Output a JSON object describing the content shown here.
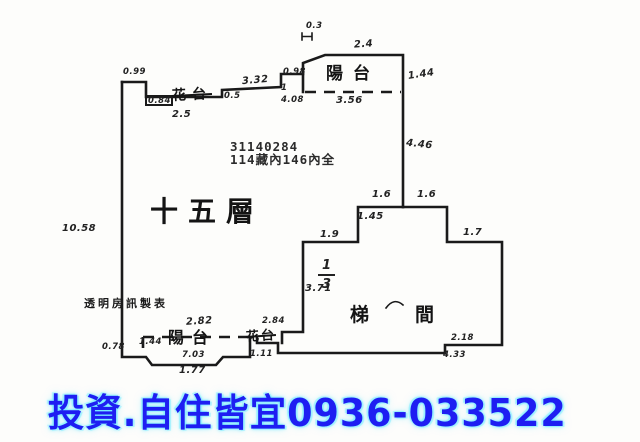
{
  "plan": {
    "typed_id": "31140284",
    "typed_line2": "114藏內146內全",
    "floor_label": "十五層",
    "stair_char1": "梯",
    "stair_char2": "間",
    "balcony_top": "陽台",
    "balcony_bottom": "陽台",
    "flowerbed_top": "花台",
    "flowerbed_bottom": "花台",
    "maker_note": "透明房訊製表",
    "fraction": {
      "num": "1",
      "den": "3"
    },
    "dims": {
      "top_offset": "0.3",
      "balcony_top_width": "2.4",
      "balcony_top_height": "1.44",
      "balcony_top_inner": "3.56",
      "corner_tl": "0.99",
      "corner_box": "0.84",
      "flowerbed_top_width": "2.5",
      "notch": "0.5",
      "run_top": "3.32",
      "step_a": "0.98",
      "step_tick": "1",
      "step_b": "4.08",
      "right_wall": "4.46",
      "bump_left_top": "1.6",
      "bump_right_top": "1.6",
      "bump_inner": "1.45",
      "step_left": "1.9",
      "step_right": "1.7",
      "stair_left_wall": "3.71",
      "left_wall": "10.58",
      "balcony_bottom_top": "2.82",
      "balcony_bottom_left": "1.44",
      "balcony_bottom_width": "7.03",
      "balcony_bottom_outer": "1.77",
      "corner_bl": "0.78",
      "flowerbed_bottom_a": "2.84",
      "flowerbed_bottom_b": "1.11",
      "stair_bottom_a": "2.18",
      "stair_bottom_b": "4.33"
    }
  },
  "footer": {
    "ad_text": "投資.自住皆宜0936-033522"
  },
  "colors": {
    "line": "#1a1a1a",
    "ad_blue": "#1e1ef2"
  }
}
